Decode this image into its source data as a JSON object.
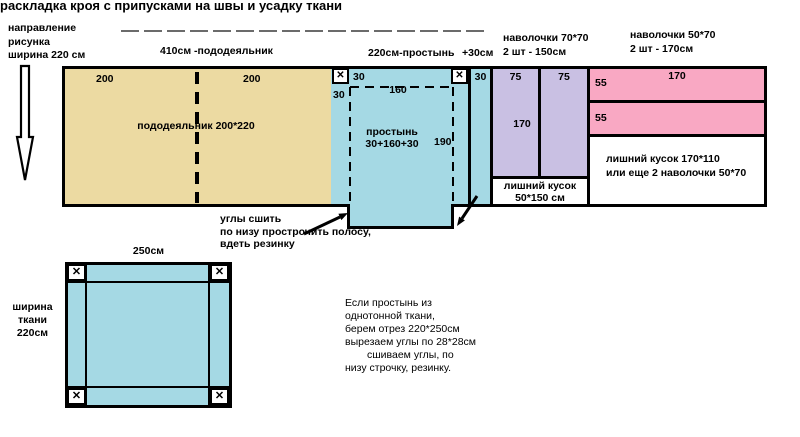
{
  "title": "раскладка кроя с припусками на швы и усадку ткани",
  "icons": {
    "cut_mark": "✕"
  },
  "direction_note": {
    "line1": "направление",
    "line2": "рисунка",
    "line3": "ширина 220 см"
  },
  "top_labels": {
    "duvet": "410см -пододеяльник",
    "sheet": "220см-простынь",
    "extra": "+30см",
    "pillows70_line1": "наволочки 70*70",
    "pillows70_line2": "2 шт - 150см",
    "pillows50_line1": "наволочки 50*70",
    "pillows50_line2": "2 шт - 170см"
  },
  "duvet": {
    "left_width": "200",
    "right_width": "200",
    "label": "пододеяльник 200*220"
  },
  "sheet": {
    "corner_seam_top": "30",
    "corner_seam_side": "30",
    "inner_width": "160",
    "inner_height": "190",
    "name": "простынь",
    "formula": "30+160+30"
  },
  "extra_strip": {
    "label": "30"
  },
  "pillows70": {
    "col1": "75",
    "col2": "75",
    "height": "170",
    "leftover_line1": "лишний кусок",
    "leftover_line2": "50*150 см"
  },
  "pillows50": {
    "width": "170",
    "bar1": "55",
    "bar2": "55",
    "leftover_line1": "лишний кусок 170*110",
    "leftover_line2": "или еще 2 наволочки 50*70"
  },
  "tab_note": {
    "line1": "углы сшить",
    "line2": "по низу прострочить полосу,",
    "line3": "вдеть резинку"
  },
  "square": {
    "top": "250см",
    "side_line1": "ширина",
    "side_line2": "ткани",
    "side_line3": "220см"
  },
  "note": {
    "line1": "Если простынь из",
    "line2": "однотонной ткани,",
    "line3": "берем отрез 220*250см",
    "line4": "вырезаем углы по 28*28см",
    "line5": "сшиваем углы, по",
    "line6": "низу строчку, резинку."
  },
  "colors": {
    "duvet": "#ecdaa2",
    "sheet": "#a5d9e4",
    "pillows70": "#c9c0e3",
    "pillows50": "#f9a8c3",
    "line": "#000000"
  }
}
